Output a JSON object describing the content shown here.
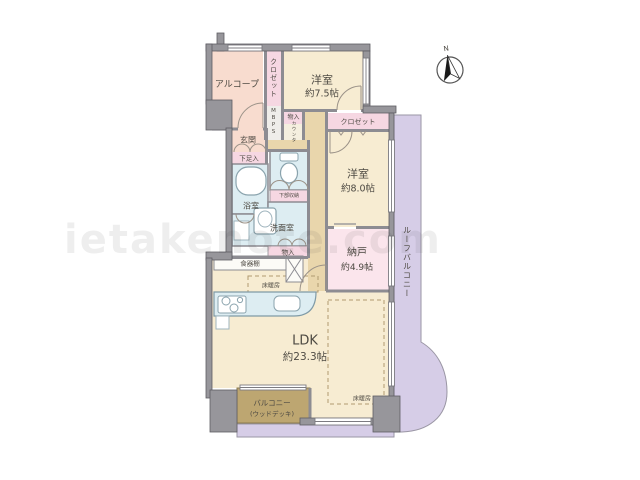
{
  "watermark": "ietakenote.com",
  "compass": {
    "north_label": "N"
  },
  "rooms": {
    "alcove": {
      "label": "アルコープ"
    },
    "closet_top": {
      "label": "クロゼット"
    },
    "bedroom1": {
      "name": "洋室",
      "size": "約7.5帖"
    },
    "meter_box": {
      "label": "MBPS"
    },
    "storage_top": {
      "label": "物入"
    },
    "counter": {
      "label": "カウンタ"
    },
    "entrance": {
      "label": "玄関"
    },
    "shoe_cabinet": {
      "label": "下足入"
    },
    "bathroom": {
      "label": "浴室"
    },
    "toilet_lower_storage": {
      "label": "下部収納"
    },
    "washroom": {
      "label": "洗面室"
    },
    "storage_mid": {
      "label": "物入"
    },
    "dish_cabinet": {
      "label": "食器棚"
    },
    "floor_heating_kitchen": {
      "label": "床暖房"
    },
    "ldk": {
      "name": "LDK",
      "size": "約23.3帖"
    },
    "closet2": {
      "label": "クロゼット"
    },
    "bedroom2": {
      "name": "洋室",
      "size": "約8.0帖"
    },
    "storage_room": {
      "name": "納戸",
      "size": "約4.9帖"
    },
    "floor_heating_living": {
      "label": "床暖房"
    },
    "balcony": {
      "line1": "バルコニー",
      "line2": "(ウッドデッキ)"
    },
    "roof_balcony": {
      "label": "ルーフバルコニー"
    }
  },
  "colors": {
    "room_cream": "#f7ecd2",
    "closet_pink": "#f6d7e2",
    "entrance_salmon": "#f8dccf",
    "wet_area_blue": "#ddedf2",
    "balcony_purple": "#d6cde7",
    "wood_deck_brown": "#bda671",
    "hall_tan": "#e9d6ac",
    "storage_room_pink": "#fbe5ec",
    "wall_gray": "#97969b"
  }
}
